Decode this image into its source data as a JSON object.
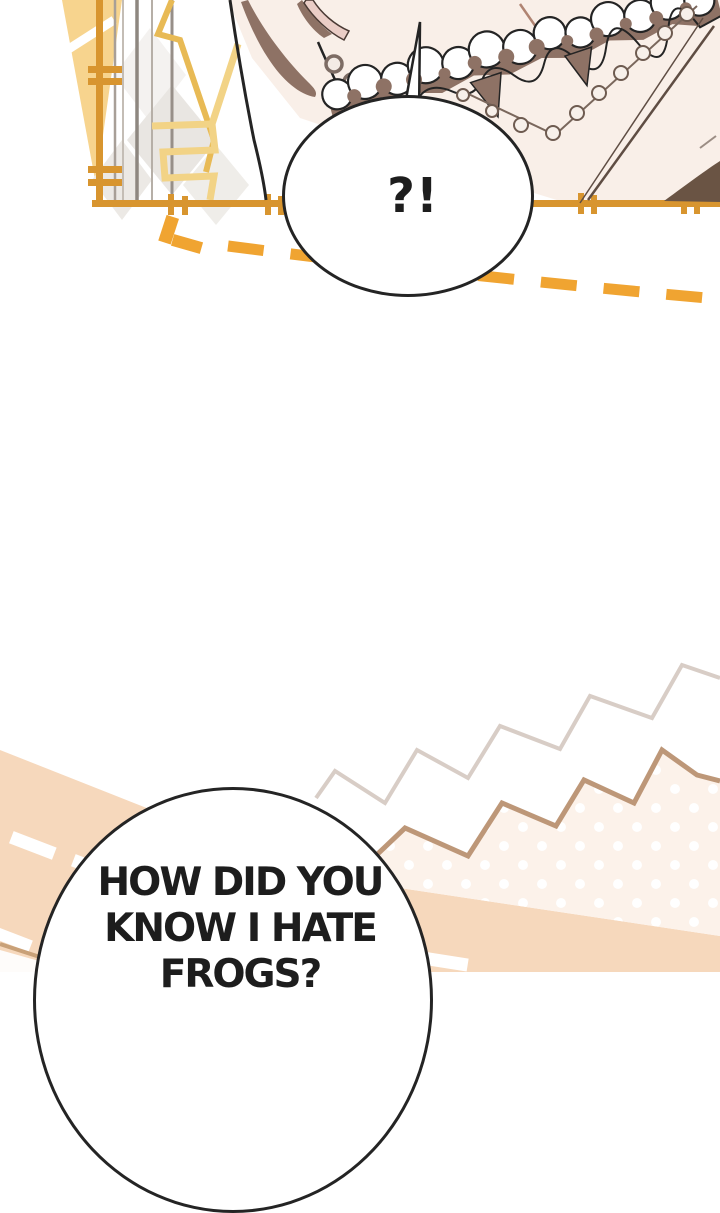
{
  "page": {
    "type": "webtoon comic page",
    "panel_count": 2
  },
  "bubbles": {
    "top": {
      "text": "?!"
    },
    "bottom": {
      "lines": [
        "HOW DID YOU",
        "KNOW I HATE",
        "FROGS?"
      ],
      "full_text": "HOW DID YOU KNOW I HATE FROGS?"
    }
  },
  "colors": {
    "ink": "#242424",
    "frame_orange": "#d8952f",
    "dash_orange": "#f0a431",
    "cream_yellow": "#f7d48e",
    "gold_zigzag": "#e8ba55",
    "background_pink": "#f9efe8",
    "hair_brown": "#8e7265",
    "road_peach": "#f6d8bc",
    "dotted_area_pink": "#fcf2ea",
    "zigzag_tan": "#bd9778",
    "zigzag_pale": "#d8cdc6"
  }
}
